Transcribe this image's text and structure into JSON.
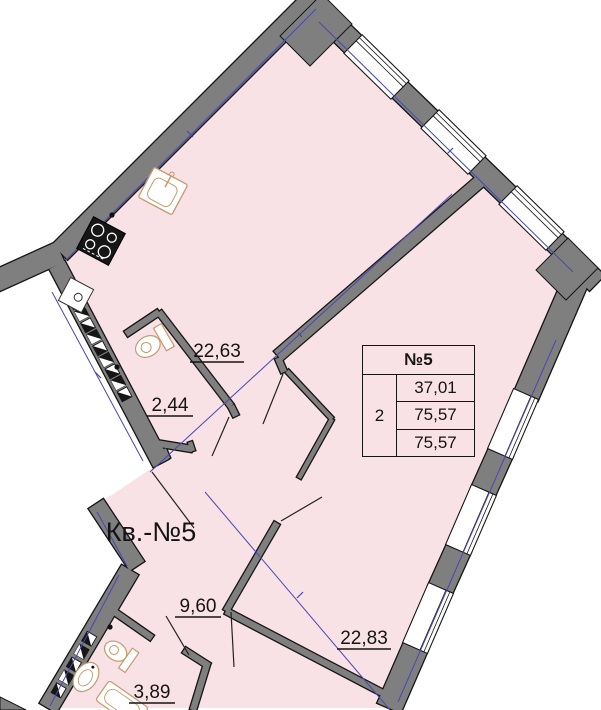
{
  "apartment": {
    "label": "Кв.-№5"
  },
  "rooms": {
    "kitchen_living": {
      "area": "22,63"
    },
    "wc": {
      "area": "2,44"
    },
    "hall": {
      "area": "9,60"
    },
    "bedroom": {
      "area": "22,83"
    },
    "bathroom": {
      "area": "3,89"
    }
  },
  "info_table": {
    "header": "№5",
    "rooms_count": "2",
    "living_area": "37,01",
    "total_area": "75,57",
    "total_area_declared": "75,57"
  },
  "colors": {
    "floor": "#f9e2e5",
    "wall": "#7f7f7f",
    "outline": "#151515",
    "axis": "#4747b5",
    "fixture": "#c49a6c"
  }
}
